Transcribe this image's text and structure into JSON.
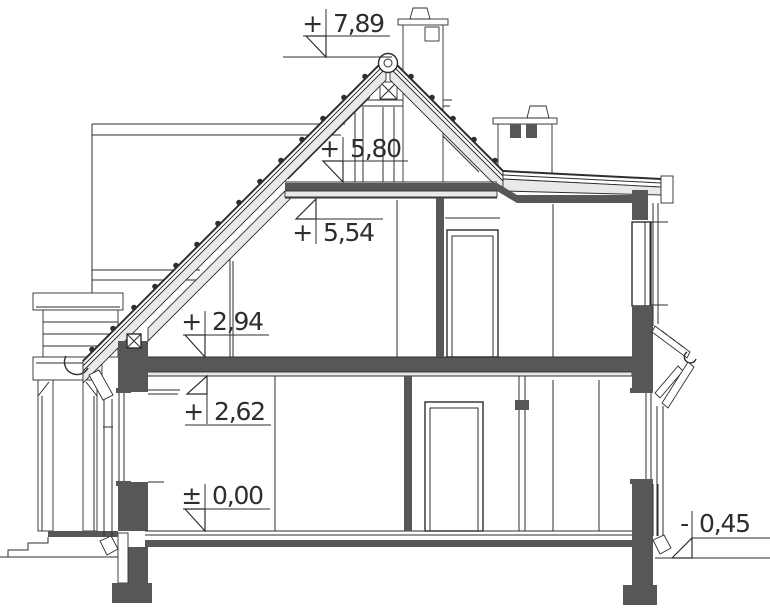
{
  "drawing": {
    "type": "architectural-cross-section",
    "levels": [
      {
        "id": "ridge",
        "sign": "+",
        "value": "7,89",
        "label": "+7,89"
      },
      {
        "id": "collar-beam",
        "sign": "+",
        "value": "5,80",
        "label": "+5,80"
      },
      {
        "id": "attic-ceiling",
        "sign": "+",
        "value": "5,54",
        "label": "+5,54"
      },
      {
        "id": "upper-floor",
        "sign": "+",
        "value": "2,94",
        "label": "+2,94"
      },
      {
        "id": "ground-ceiling",
        "sign": "+",
        "value": "2,62",
        "label": "+2,62"
      },
      {
        "id": "ground-floor",
        "sign": "±",
        "value": "0,00",
        "label": "±0,00"
      },
      {
        "id": "terrain",
        "sign": "-",
        "value": "0,45",
        "label": "-0,45"
      }
    ],
    "colors": {
      "line": "#2e2e2e",
      "section_fill": "#575757",
      "insulation_fill": "#e9e9e9",
      "background": "#ffffff"
    }
  }
}
